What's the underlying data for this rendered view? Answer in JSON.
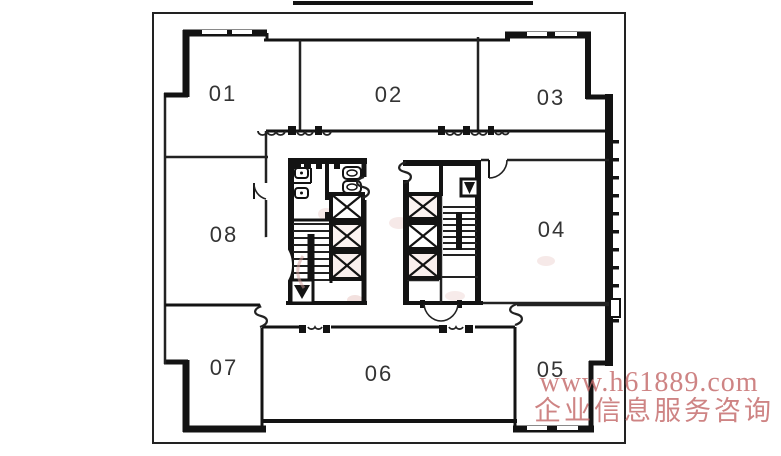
{
  "rooms": [
    {
      "id": "01",
      "label": "01"
    },
    {
      "id": "02",
      "label": "02"
    },
    {
      "id": "03",
      "label": "03"
    },
    {
      "id": "04",
      "label": "04"
    },
    {
      "id": "05",
      "label": "05"
    },
    {
      "id": "06",
      "label": "06"
    },
    {
      "id": "07",
      "label": "07"
    },
    {
      "id": "08",
      "label": "08"
    }
  ],
  "watermark": {
    "line1": "www.h61889.com",
    "line2": "企业信息服务咨询",
    "color": "#c46a6a"
  },
  "colors": {
    "wall": "#131313",
    "paper": "#ffffff",
    "label": "#343434",
    "smudge": "#d79a96"
  }
}
